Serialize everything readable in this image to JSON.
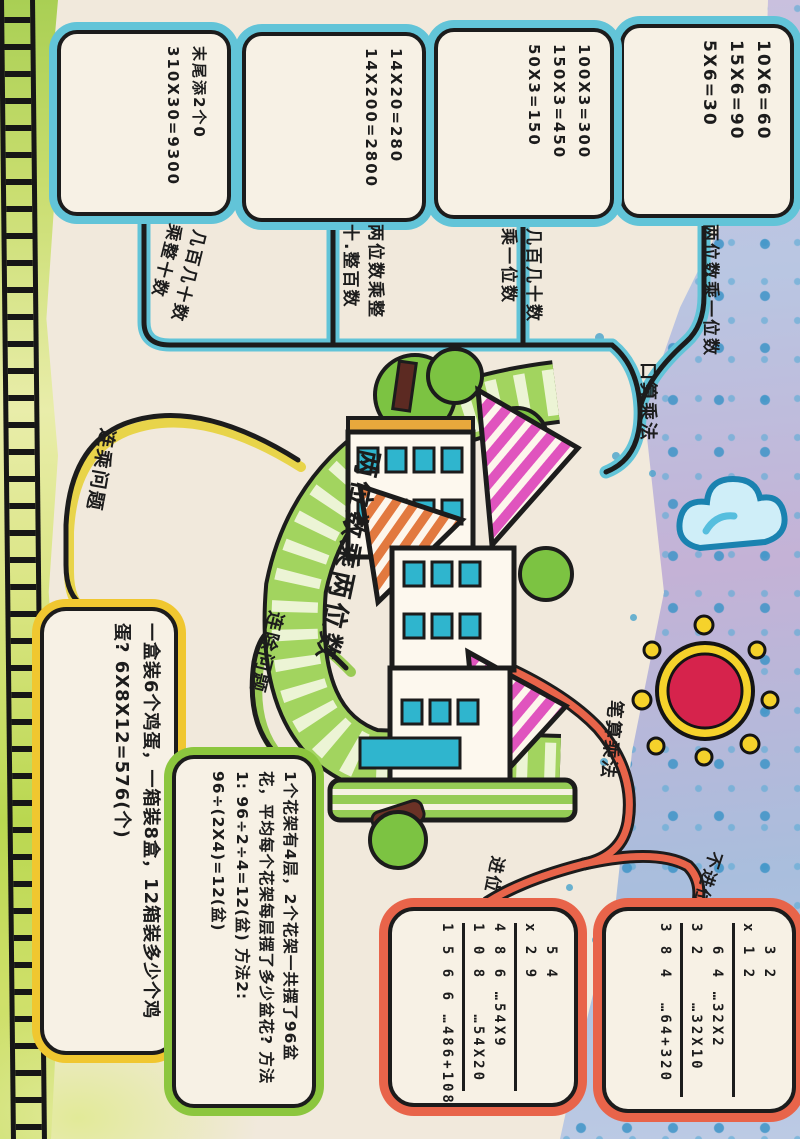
{
  "poster": {
    "title": "两位数乘两位数",
    "oral": {
      "label": "口算乘法",
      "children": [
        {
          "label": "两位数乘一位数",
          "lines": [
            "10X6=60",
            "15X6=90",
            "5X6=30"
          ]
        },
        {
          "label": "几百几十数乘一位数",
          "lines": [
            "100X3=300",
            "150X3=450",
            "50X3=150"
          ]
        },
        {
          "label": "两位数乘整十.整百数",
          "lines": [
            "14X20=280",
            "14X200=2800"
          ]
        },
        {
          "label": "几百几十数乘整十数",
          "lines": [
            "末尾添2个0",
            "310X30=9300"
          ]
        }
      ]
    },
    "lianCheng": {
      "label": "连乘问题",
      "problem": "一盒装6个鸡蛋，一箱装8盒，12箱装多少个鸡蛋? 6X8X12=576(个)"
    },
    "lianChu": {
      "label": "连除问题",
      "problem": "1个花架有4层，2个花架一共摆了96盆花，平均每个花架每层摆了多少盆花? 方法1: 96÷2÷4=12(盆) 方法2: 96÷(2X4)=12(盆)"
    },
    "written": {
      "label": "笔算乘法",
      "carry": {
        "label": "进位",
        "lines": [
          "  5 4",
          "x 2 9",
          "4 8 6 …54X9",
          "1 0 8   …54X20",
          "1 5 6 6 …486+1080"
        ]
      },
      "noCarry": {
        "label": "不进位",
        "lines": [
          "  3 2",
          "x 1 2",
          "  6 4 …32X2",
          "3 2    …32X10",
          "3 8 4  …64+320"
        ]
      }
    },
    "colors": {
      "paper": "#f1e9dc",
      "cyan": "#62c4d8",
      "yellow": "#f0c730",
      "green": "#8cc63e",
      "red": "#e8644a",
      "ink": "#1c1c1c"
    }
  }
}
